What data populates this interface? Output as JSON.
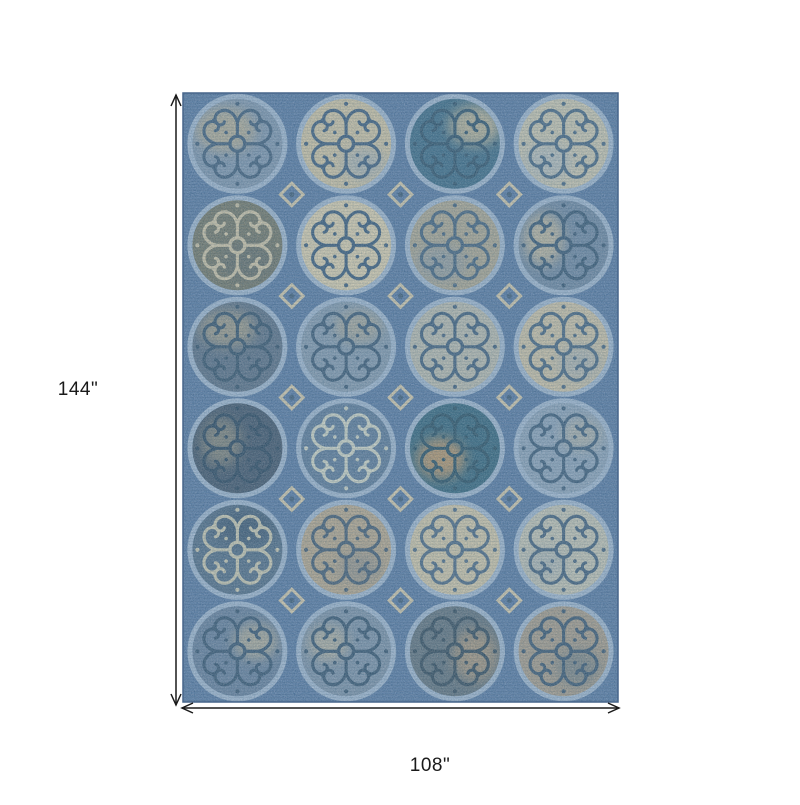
{
  "figure": {
    "type": "product-dimension-diagram",
    "product": "blue medallion scroll area rug",
    "height_label": "144\"",
    "width_label": "108\"",
    "label_color": "#1a1a1a",
    "rug": {
      "x": 183,
      "y": 93,
      "width": 435,
      "height": 609,
      "columns": 4,
      "rows": 6,
      "palette": {
        "base": "#5a7aa2",
        "ring": "#9db2ca",
        "border": "#47658a",
        "diamond": "#ccc2a8",
        "diamond_dot": "#44617d"
      },
      "cells": [
        {
          "fill": "#7e94ac",
          "scroll": "#44617d",
          "patch": {
            "color": "#b6ab91",
            "dx": -12,
            "dy": -14,
            "rx": 30,
            "ry": 22,
            "op": 0.8
          }
        },
        {
          "fill": "#c6bca1",
          "scroll": "#42607e",
          "patch": {
            "color": "#8fa3b7",
            "dx": 18,
            "dy": 20,
            "rx": 22,
            "ry": 16,
            "op": 0.55
          }
        },
        {
          "fill": "#416d88",
          "scroll": "#35576f",
          "patch": {
            "color": "#c2b699",
            "dx": 20,
            "dy": -18,
            "rx": 26,
            "ry": 20,
            "op": 0.85
          }
        },
        {
          "fill": "#c1beac",
          "scroll": "#4a6883",
          "patch": {
            "color": "#9cadbf",
            "dx": -16,
            "dy": 18,
            "rx": 24,
            "ry": 18,
            "op": 0.5
          }
        },
        {
          "fill": "#73776b",
          "scroll": "#c7bda3",
          "patch": {
            "color": "#5f6a70",
            "dx": 10,
            "dy": 16,
            "rx": 28,
            "ry": 20,
            "op": 0.5
          }
        },
        {
          "fill": "#cfc5aa",
          "scroll": "#3f5e7c",
          "patch": null
        },
        {
          "fill": "#a7a291",
          "scroll": "#48657f",
          "patch": {
            "color": "#7e93a9",
            "dx": -14,
            "dy": 18,
            "rx": 26,
            "ry": 18,
            "op": 0.5
          }
        },
        {
          "fill": "#6f87a1",
          "scroll": "#3d5b76",
          "patch": {
            "color": "#c4b89c",
            "dx": -20,
            "dy": -6,
            "rx": 20,
            "ry": 26,
            "op": 0.8
          }
        },
        {
          "fill": "#5d7187",
          "scroll": "#3a566e",
          "patch": {
            "color": "#b1a68b",
            "dx": -10,
            "dy": -18,
            "rx": 28,
            "ry": 18,
            "op": 0.7
          }
        },
        {
          "fill": "#8297ac",
          "scroll": "#3f5c77",
          "patch": {
            "color": "#b4a98f",
            "dx": 12,
            "dy": -20,
            "rx": 24,
            "ry": 16,
            "op": 0.6
          }
        },
        {
          "fill": "#b2b4ab",
          "scroll": "#45627e",
          "patch": null
        },
        {
          "fill": "#c3baa3",
          "scroll": "#4a6781",
          "patch": {
            "color": "#8ba1b7",
            "dx": 16,
            "dy": 16,
            "rx": 22,
            "ry": 18,
            "op": 0.45
          }
        },
        {
          "fill": "#46596e",
          "scroll": "#314b62",
          "patch": {
            "color": "#afa489",
            "dx": -16,
            "dy": -6,
            "rx": 20,
            "ry": 24,
            "op": 0.55
          }
        },
        {
          "fill": "#5f7b99",
          "scroll": "#c7ccc0",
          "patch": null
        },
        {
          "fill": "#3a687f",
          "scroll": "#2f5468",
          "patch": {
            "color": "#c29a6d",
            "dx": -14,
            "dy": 10,
            "rx": 24,
            "ry": 20,
            "op": 0.85
          }
        },
        {
          "fill": "#8ba0b6",
          "scroll": "#42607c",
          "patch": {
            "color": "#c0b59b",
            "dx": 18,
            "dy": -14,
            "rx": 20,
            "ry": 16,
            "op": 0.5
          }
        },
        {
          "fill": "#567089",
          "scroll": "#c3c1ad",
          "patch": {
            "color": "#3e576f",
            "dx": 6,
            "dy": -22,
            "rx": 30,
            "ry": 18,
            "op": 0.7
          }
        },
        {
          "fill": "#b0a28c",
          "scroll": "#485f75",
          "patch": {
            "color": "#76808a",
            "dx": 14,
            "dy": 18,
            "rx": 22,
            "ry": 16,
            "op": 0.45
          }
        },
        {
          "fill": "#c7bea5",
          "scroll": "#506b85",
          "patch": null
        },
        {
          "fill": "#bbbcb0",
          "scroll": "#47637e",
          "patch": {
            "color": "#8fa0b0",
            "dx": -18,
            "dy": 14,
            "rx": 20,
            "ry": 16,
            "op": 0.4
          }
        },
        {
          "fill": "#68809c",
          "scroll": "#3c5974",
          "patch": {
            "color": "#bfb499",
            "dx": 18,
            "dy": -10,
            "rx": 22,
            "ry": 18,
            "op": 0.7
          }
        },
        {
          "fill": "#7b90a6",
          "scroll": "#3b5872",
          "patch": {
            "color": "#c1b69b",
            "dx": -18,
            "dy": -8,
            "rx": 20,
            "ry": 18,
            "op": 0.65
          }
        },
        {
          "fill": "#63737f",
          "scroll": "#394f60",
          "patch": {
            "color": "#b89f80",
            "dx": 20,
            "dy": 4,
            "rx": 22,
            "ry": 26,
            "op": 0.7
          }
        },
        {
          "fill": "#a2988a",
          "scroll": "#3f5a73",
          "patch": {
            "color": "#5a7283",
            "dx": 14,
            "dy": 16,
            "rx": 22,
            "ry": 18,
            "op": 0.5
          }
        }
      ]
    },
    "annotations": {
      "vertical_arrow": {
        "x": 176,
        "y1": 95,
        "y2": 705
      },
      "horizontal_arrow": {
        "y": 708,
        "x1": 182,
        "x2": 619
      },
      "stroke": "#1a1a1a"
    }
  }
}
